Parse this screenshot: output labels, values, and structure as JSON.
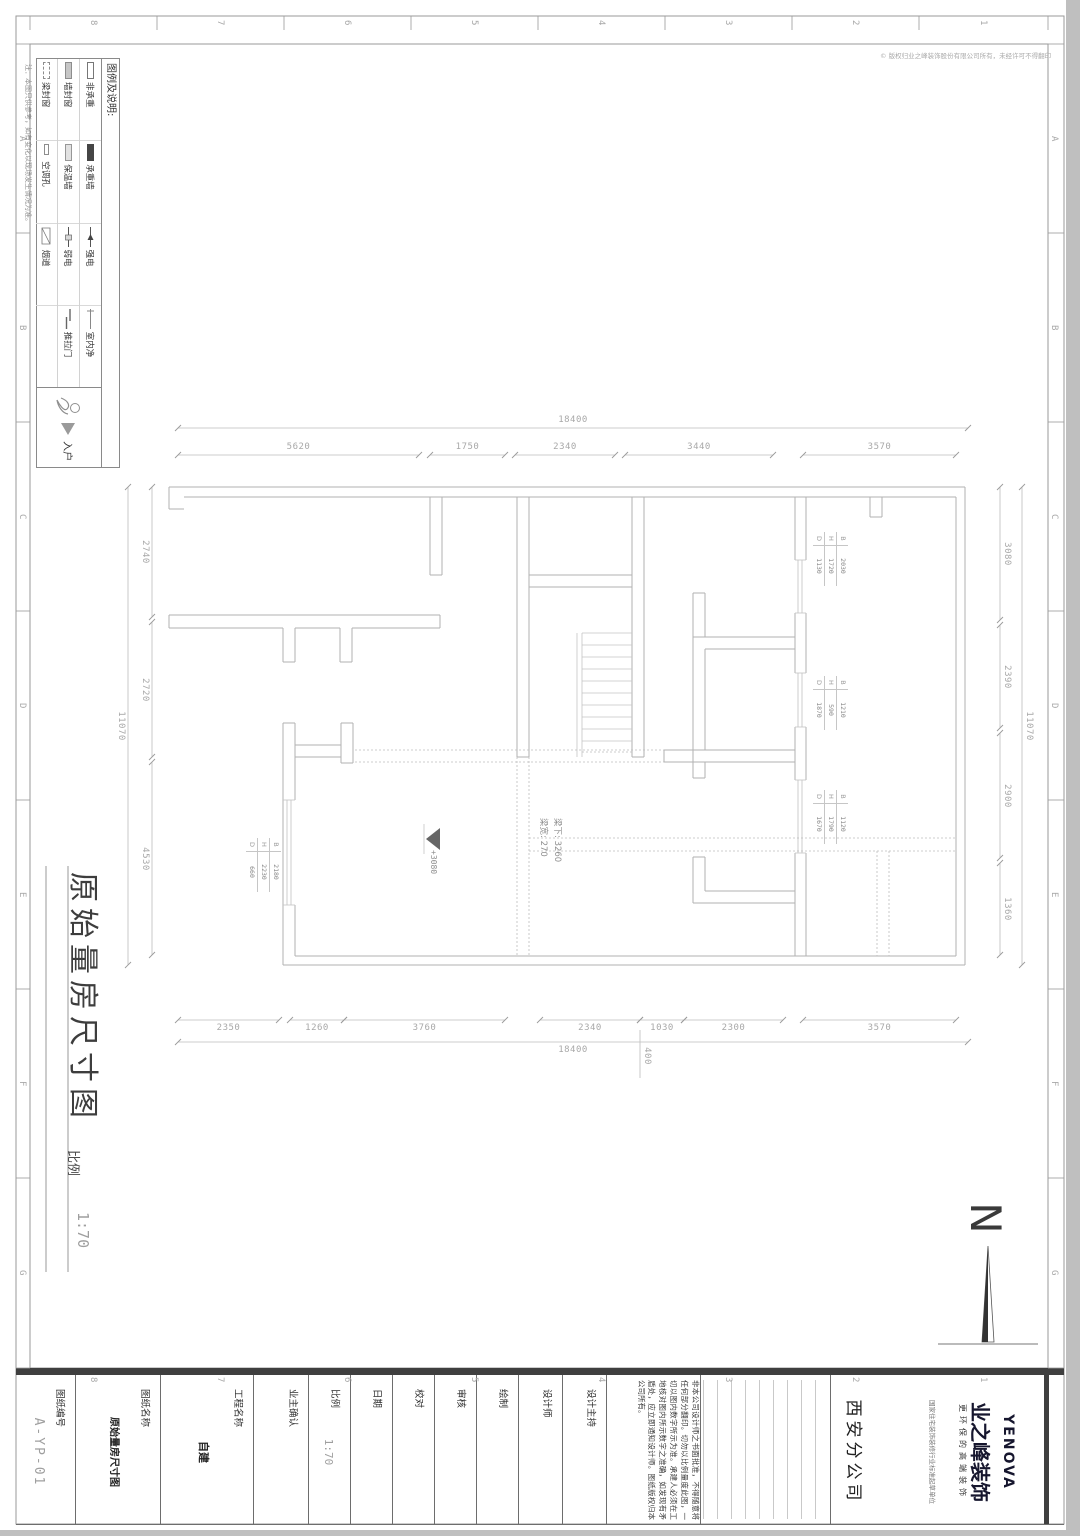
{
  "page": {
    "copyright": "© 版权归业之峰装饰股份有限公司所有，未经许可不得翻印",
    "grid_numbers": [
      "8",
      "7",
      "6",
      "5",
      "4",
      "3",
      "2",
      "1"
    ],
    "grid_letters": [
      "A",
      "B",
      "C",
      "D",
      "E",
      "F",
      "G"
    ]
  },
  "legend": {
    "title": "图例及说明:",
    "note": "注：本图只供参考，如有变化以现场发生情况为准。",
    "entry": "入户",
    "items": [
      {
        "label": "非承重"
      },
      {
        "label": "承重墙"
      },
      {
        "label": "强电"
      },
      {
        "label": "室内净"
      },
      {
        "label": "墙封窗"
      },
      {
        "label": "保温墙"
      },
      {
        "label": "弱电"
      },
      {
        "label": "推拉门"
      },
      {
        "label": "梁封窗"
      },
      {
        "label": "空调孔"
      },
      {
        "label": "烟道"
      },
      {
        "label": ""
      }
    ]
  },
  "plan": {
    "dims": {
      "top_total": "18400",
      "top": [
        "5620",
        "1750",
        "2340",
        "3440",
        "3570"
      ],
      "bottom": [
        "2350",
        "1260",
        "3760",
        "2340",
        "1030",
        "2300",
        "3570"
      ],
      "bottom_total": "18400",
      "bottom_offset": "400",
      "left": [
        "2740",
        "2720",
        "4530"
      ],
      "left_total": "11070",
      "right": [
        "3080",
        "2390",
        "2900",
        "1360"
      ],
      "right_total": "11070"
    },
    "beam_note_1": "梁宽: 270",
    "beam_note_2": "梁下: 3260",
    "level_mark": "+3080",
    "win_labels": {
      "b": "B",
      "h": "H",
      "d": "D"
    },
    "windows": [
      {
        "B": "2030",
        "H": "1720",
        "D": "1130"
      },
      {
        "B": "1210",
        "H": "590",
        "D": "1870"
      },
      {
        "B": "1120",
        "H": "1790",
        "D": "1670"
      },
      {
        "B": "2180",
        "H": "2230",
        "D": "660"
      }
    ]
  },
  "title_area": {
    "title": "原始量房尺寸图",
    "scale_label": "比例",
    "scale_value": "1:70"
  },
  "north": {
    "label": "N"
  },
  "titleblock": {
    "fields": [
      {
        "label": "图纸编号",
        "value": "A-YP-01"
      },
      {
        "label": "图纸名称",
        "value": "原始量房尺寸图"
      },
      {
        "label": "工程名称",
        "value": "自建"
      },
      {
        "label": "业主确认",
        "value": ""
      },
      {
        "label": "比例",
        "value": "1:70"
      },
      {
        "label": "日期",
        "value": ""
      },
      {
        "label": "校对",
        "value": ""
      },
      {
        "label": "审核",
        "value": ""
      },
      {
        "label": "绘制",
        "value": ""
      },
      {
        "label": "设计师",
        "value": ""
      },
      {
        "label": "设计主持",
        "value": ""
      }
    ],
    "disclaimer": "非本公司设计师之书面批准，不得随意将任何部分翻印。切勿以比例量度此图，一切以图内数字所示为准。承建人必须在工地核对图内所示数字之准确，如发现有矛盾处，应立即通知设计师。图纸版权归本公司所有。",
    "branch": "西安分公司",
    "cert": "国家住宅装饰装修行业标准起草单位",
    "logo": {
      "en": "YENOVA",
      "cn": "业之峰装饰",
      "slogan": "更环保的高端装饰"
    }
  }
}
